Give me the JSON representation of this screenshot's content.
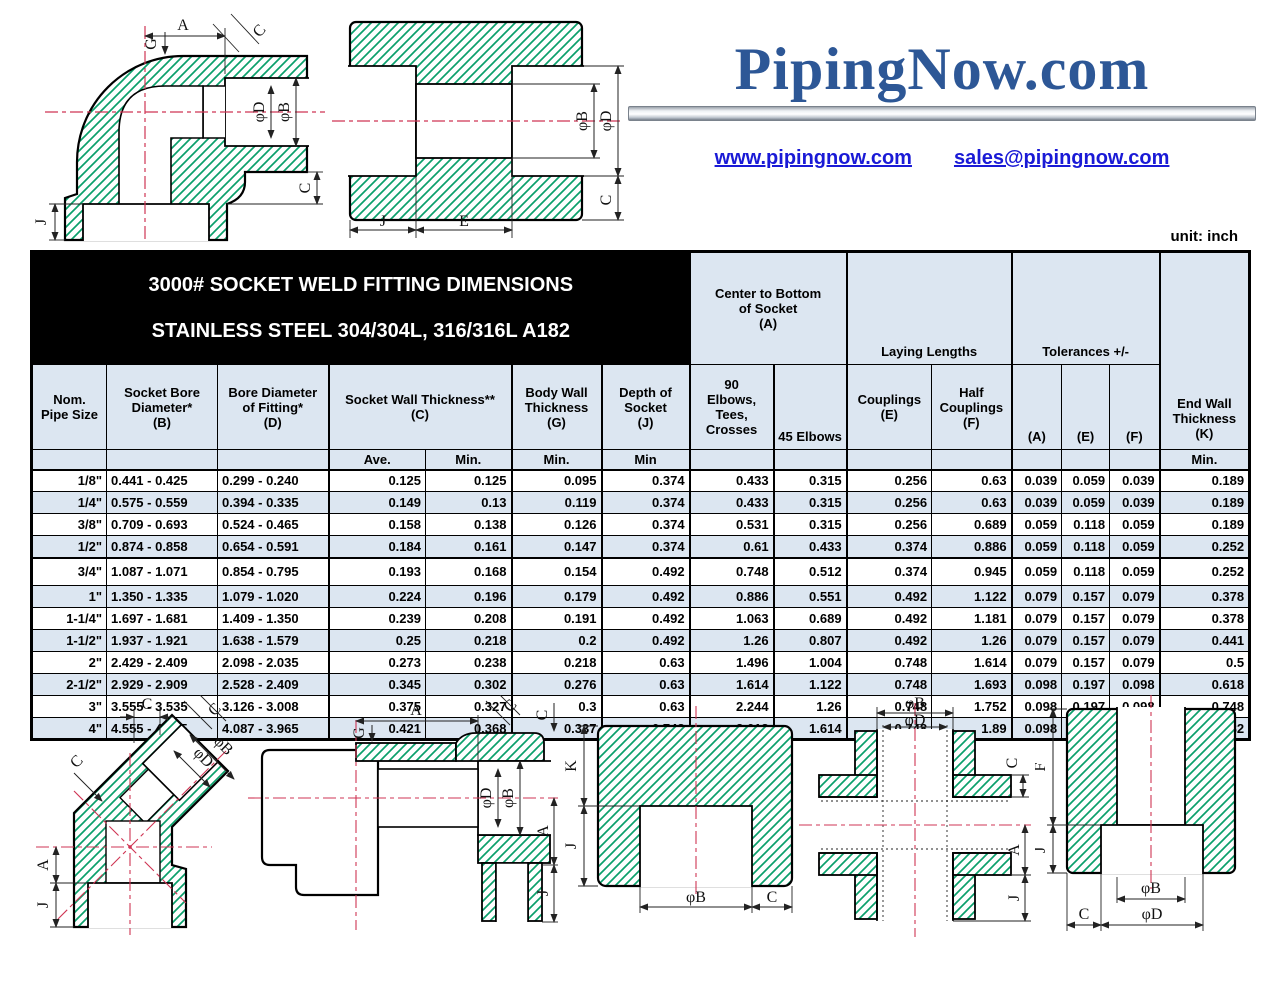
{
  "logo": {
    "text": "PipingNow.com",
    "website": "www.pipingnow.com",
    "email": "sales@pipingnow.com"
  },
  "page": {
    "unit_label": "unit: inch"
  },
  "table": {
    "title_line1": "3000# SOCKET WELD FITTING DIMENSIONS",
    "title_line2": "STAINLESS STEEL 304/304L, 316/316L  A182",
    "headers": {
      "center_bottom": "Center to Bottom\nof Socket\n(A)",
      "laying": "Laying Lengths",
      "tolerances": "Tolerances +/-",
      "end_wall": "End Wall\nThickness\n(K)",
      "nom": "Nom.\nPipe Size",
      "b": "Socket Bore\nDiameter*\n(B)",
      "d": "Bore Diameter\nof Fitting*\n(D)",
      "c": "Socket Wall Thickness**\n(C)",
      "g": "Body Wall\nThickness\n(G)",
      "j": "Depth of\nSocket\n(J)",
      "e90": "90\nElbows,\nTees,\nCrosses",
      "e45": "45 Elbows",
      "coup": "Couplings\n(E)",
      "half": "Half\nCouplings\n(F)",
      "ta": "(A)",
      "te": "(E)",
      "tf": "(F)"
    },
    "subheader": [
      "",
      "",
      "",
      "Ave.",
      "Min.",
      "Min.",
      "Min",
      "",
      "",
      "",
      "",
      "",
      "",
      "",
      "Min."
    ],
    "rows": [
      [
        "1/8\"",
        "0.441 - 0.425",
        "0.299 - 0.240",
        "0.125",
        "0.125",
        "0.095",
        "0.374",
        "0.433",
        "0.315",
        "0.256",
        "0.63",
        "0.039",
        "0.059",
        "0.039",
        "0.189"
      ],
      [
        "1/4\"",
        "0.575 - 0.559",
        "0.394 - 0.335",
        "0.149",
        "0.13",
        "0.119",
        "0.374",
        "0.433",
        "0.315",
        "0.256",
        "0.63",
        "0.039",
        "0.059",
        "0.039",
        "0.189"
      ],
      [
        "3/8\"",
        "0.709 - 0.693",
        "0.524 - 0.465",
        "0.158",
        "0.138",
        "0.126",
        "0.374",
        "0.531",
        "0.315",
        "0.256",
        "0.689",
        "0.059",
        "0.118",
        "0.059",
        "0.189"
      ],
      [
        "1/2\"",
        "0.874 - 0.858",
        "0.654 - 0.591",
        "0.184",
        "0.161",
        "0.147",
        "0.374",
        "0.61",
        "0.433",
        "0.374",
        "0.886",
        "0.059",
        "0.118",
        "0.059",
        "0.252"
      ],
      [
        "3/4\"",
        "1.087 - 1.071",
        "0.854 - 0.795",
        "0.193",
        "0.168",
        "0.154",
        "0.492",
        "0.748",
        "0.512",
        "0.374",
        "0.945",
        "0.059",
        "0.118",
        "0.059",
        "0.252"
      ],
      [
        "1\"",
        "1.350 - 1.335",
        "1.079 - 1.020",
        "0.224",
        "0.196",
        "0.179",
        "0.492",
        "0.886",
        "0.551",
        "0.492",
        "1.122",
        "0.079",
        "0.157",
        "0.079",
        "0.378"
      ],
      [
        "1-1/4\"",
        "1.697 - 1.681",
        "1.409 - 1.350",
        "0.239",
        "0.208",
        "0.191",
        "0.492",
        "1.063",
        "0.689",
        "0.492",
        "1.181",
        "0.079",
        "0.157",
        "0.079",
        "0.378"
      ],
      [
        "1-1/2\"",
        "1.937 - 1.921",
        "1.638 - 1.579",
        "0.25",
        "0.218",
        "0.2",
        "0.492",
        "1.26",
        "0.807",
        "0.492",
        "1.26",
        "0.079",
        "0.157",
        "0.079",
        "0.441"
      ],
      [
        "2\"",
        "2.429 - 2.409",
        "2.098 - 2.035",
        "0.273",
        "0.238",
        "0.218",
        "0.63",
        "1.496",
        "1.004",
        "0.748",
        "1.614",
        "0.079",
        "0.157",
        "0.079",
        "0.5"
      ],
      [
        "2-1/2\"",
        "2.929 - 2.909",
        "2.528 - 2.409",
        "0.345",
        "0.302",
        "0.276",
        "0.63",
        "1.614",
        "1.122",
        "0.748",
        "1.693",
        "0.098",
        "0.197",
        "0.098",
        "0.618"
      ],
      [
        "3\"",
        "3.555 - 3.535",
        "3.126 - 3.008",
        "0.375",
        "0.327",
        "0.3",
        "0.63",
        "2.244",
        "1.26",
        "0.748",
        "1.752",
        "0.098",
        "0.197",
        "0.098",
        "0.748"
      ],
      [
        "4\"",
        "4.555 - 4.535",
        "4.087 - 3.965",
        "0.421",
        "0.368",
        "0.337",
        "0.748",
        "2.618",
        "1.614",
        "0.748",
        "1.89",
        "0.098",
        "0.197",
        "0.098",
        "0.882"
      ]
    ]
  },
  "drawings": {
    "colors": {
      "hatch_green": "#0ca06c",
      "centerline_red": "#cf3554",
      "outline": "#000000"
    },
    "elbow90": {
      "a": "A",
      "c_top": "C",
      "g": "G",
      "phid": "φD",
      "phib": "φB",
      "c_bottom": "C",
      "j": "J"
    },
    "coupling": {
      "phib": "φB",
      "phid": "φD",
      "c": "C",
      "j": "J",
      "e": "E"
    },
    "elbow45": {
      "c_top": "C",
      "c_right": "C",
      "c_left": "C",
      "phib": "φB",
      "phid": "φD",
      "a": "A",
      "j": "J"
    },
    "tee": {
      "a": "A",
      "g": "G",
      "c_diag": "C",
      "c_right": "C",
      "phid": "φD",
      "phib": "φB",
      "a_right": "A",
      "j": "J"
    },
    "cap": {
      "k": "K",
      "j": "J",
      "phib": "φB",
      "c": "C"
    },
    "cross": {
      "phib": "φB",
      "phid": "φD",
      "c": "C",
      "a": "A",
      "j": "J"
    },
    "halfcoupling": {
      "f": "F",
      "j": "J",
      "phib": "φB",
      "phid": "φD",
      "c": "C"
    }
  }
}
